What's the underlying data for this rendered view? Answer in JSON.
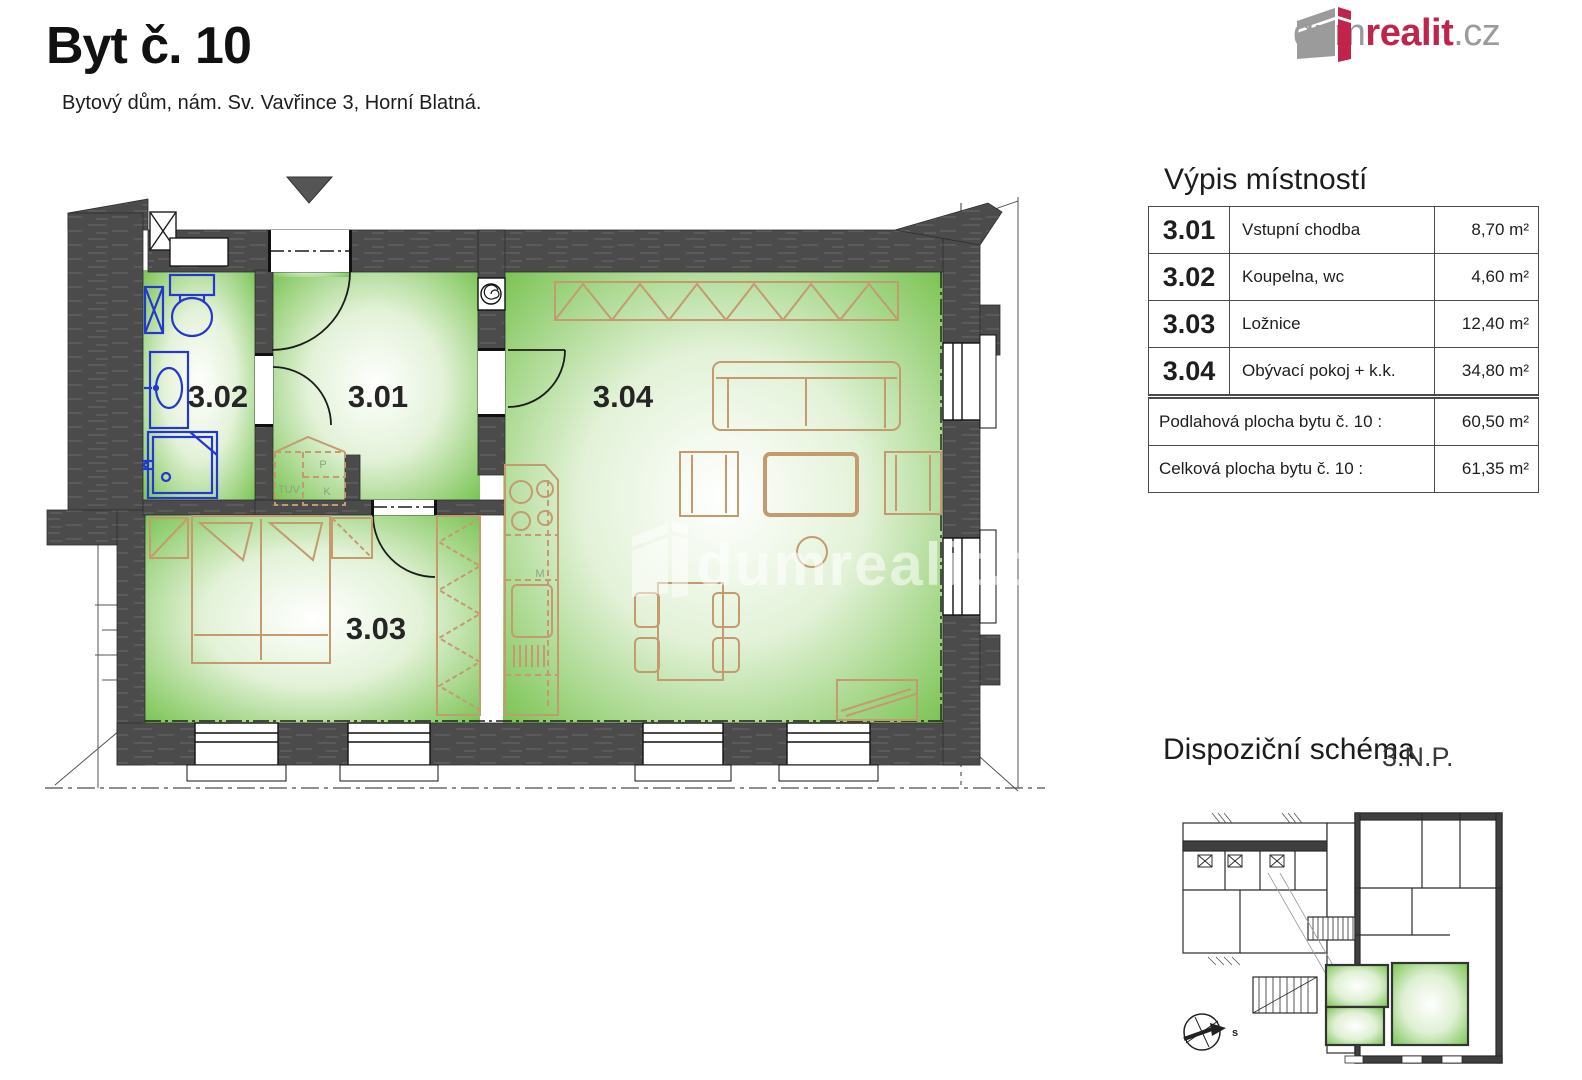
{
  "header": {
    "title": "Byt č. 10",
    "subtitle": "Bytový dům, nám. Sv. Vavřince 3, Horní Blatná."
  },
  "logo": {
    "gray": "dum",
    "red": "realit",
    "tld": ".cz"
  },
  "room_table": {
    "title": "Výpis místností",
    "rows": [
      {
        "number": "3.01",
        "name": "Vstupní chodba",
        "area": "8,70 m²"
      },
      {
        "number": "3.02",
        "name": "Koupelna, wc",
        "area": "4,60 m²"
      },
      {
        "number": "3.03",
        "name": "Ložnice",
        "area": "12,40 m²"
      },
      {
        "number": "3.04",
        "name": "Obývací pokoj + k.k.",
        "area": "34,80 m²"
      }
    ],
    "summary": [
      {
        "label": "Podlahová plocha bytu  č. 10 :",
        "value": "60,50 m²"
      },
      {
        "label": "Celková plocha bytu  č. 10 :",
        "value": "61,35 m²"
      }
    ]
  },
  "floor_plan": {
    "labels": {
      "r301": "3.01",
      "r302": "3.02",
      "r303": "3.03",
      "r304": "3.04"
    },
    "closet": {
      "tuv": "TUV",
      "p": "P",
      "k": "K"
    },
    "kitchen_mark": "M",
    "watermark": "dumrealit.cz"
  },
  "schema": {
    "title": "Dispoziční schéma",
    "floor": "3.N.P.",
    "compass": "s"
  },
  "colors": {
    "wall_gray": "#4b4b4b",
    "room_green": "#76c24e",
    "furniture_tan": "#c49b6e",
    "sanitary_blue": "#2438cf",
    "logo_red": "#c0244a",
    "logo_gray": "#9b9b9b"
  }
}
